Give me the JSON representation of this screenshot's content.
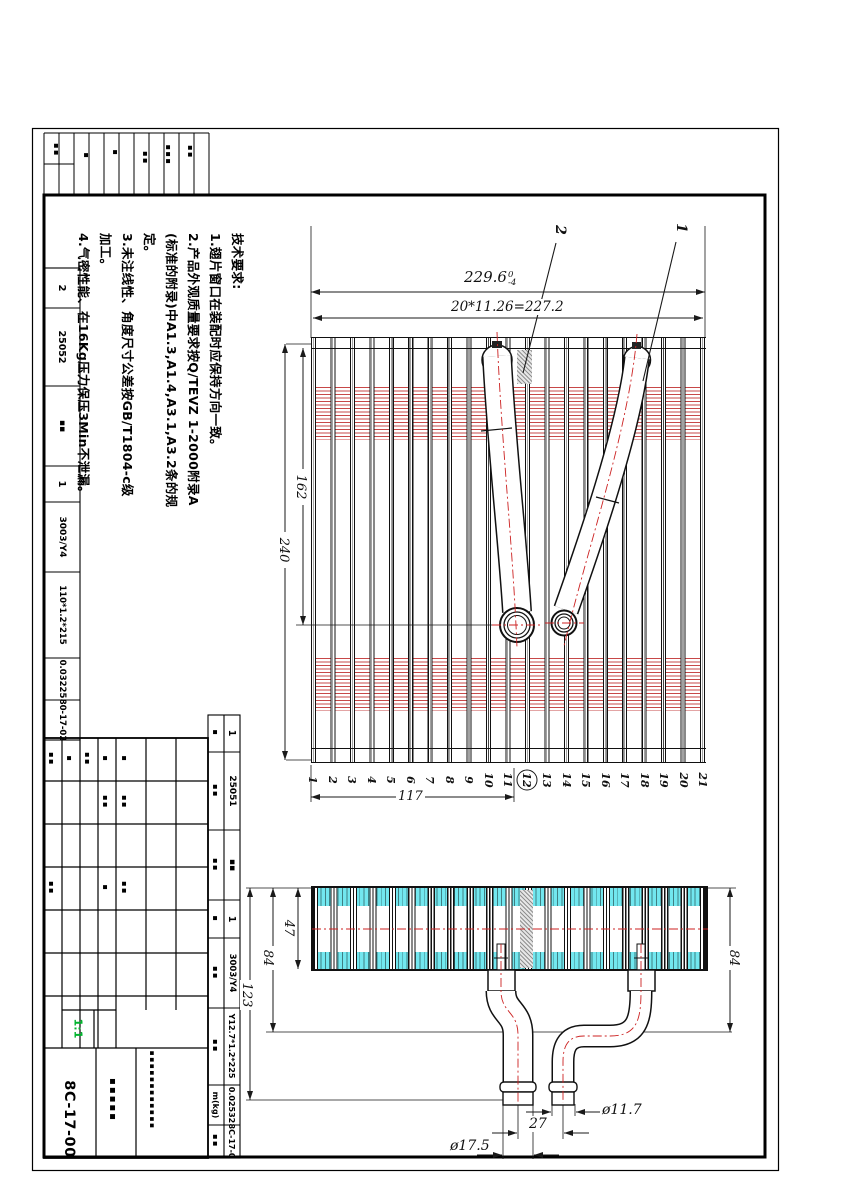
{
  "frame": {
    "drawing_no": "8C-17-00",
    "scale": "1:1",
    "scale_color": "#00b32c",
    "accent_red": "#cc2222",
    "fin_cyan": "#72e7ef"
  },
  "notes": {
    "l0": "技术要求:",
    "l1": "1.翅片窗口在装配时应保持方向一致。",
    "l2": "2.产品外观质量要求按Q/TEVZ 1-2000附录A",
    "l3": "(标准的附录)中A1.3,A1.4,A3.1,A3.2条的规",
    "l4": "定。",
    "l5": "3.未注线性、角度尺寸公差按GB/T1804-c级",
    "l6": "加工。",
    "l7": "4.气密性能、在16Kg压力保压3Min不泄漏。"
  },
  "dims": {
    "overall": "229.6",
    "tol_up": "0",
    "tol_dn": "-4",
    "pitch": "20*11.26=227.2",
    "height_162": "162",
    "height_240": "240",
    "width_117": "117",
    "fin_47": "47",
    "d84_left": "84",
    "d84_right": "84",
    "d123": "123",
    "d27": "27",
    "dia_small": "ø11.7",
    "dia_large": "ø17.5"
  },
  "callouts": {
    "c1": "1",
    "c2": "2"
  },
  "tubes": [
    "1",
    "2",
    "3",
    "4",
    "5",
    "6",
    "7",
    "8",
    "9",
    "10",
    "11",
    "12",
    "13",
    "14",
    "15",
    "16",
    "17",
    "18",
    "19",
    "20",
    "21"
  ],
  "circled_tube": "12",
  "parts_row2": {
    "c0": "2",
    "c1": "25052",
    "c2": "▪▪",
    "c3": "1",
    "c4": "3003/Y4",
    "c5": "110*1.2*215",
    "c6": "0.03225",
    "c7": "80-17-02"
  },
  "parts_row1": {
    "h0": "▪",
    "h1": "▪▪",
    "h2": "▪▪",
    "h3": "▪",
    "h4": "▪▪",
    "h5": "▪▪",
    "h6": "m(kg)",
    "h7": "▪▪",
    "c0": "1",
    "c1": "25051",
    "c2": "▪▪",
    "c3": "1",
    "c4": "3003/Y4",
    "c5": "Y12.7*1.2*225",
    "c6": "0.02532",
    "c7": "8C-17-0"
  },
  "title_block": {
    "part_name": "▪▪▪▪▪",
    "company": "▪▪▪▪▪▪▪▪▪▪▪▪",
    "sig_blobs": [
      "▪▪",
      "▪",
      "▪▪",
      "▪",
      "▪▪",
      "▪",
      "▪▪",
      "▪▪",
      "▪",
      "▪▪"
    ]
  },
  "top_table": {
    "blobs": [
      "▪▪",
      "▪",
      "▪",
      "▪▪",
      "▪▪▪",
      "▪▪"
    ]
  }
}
